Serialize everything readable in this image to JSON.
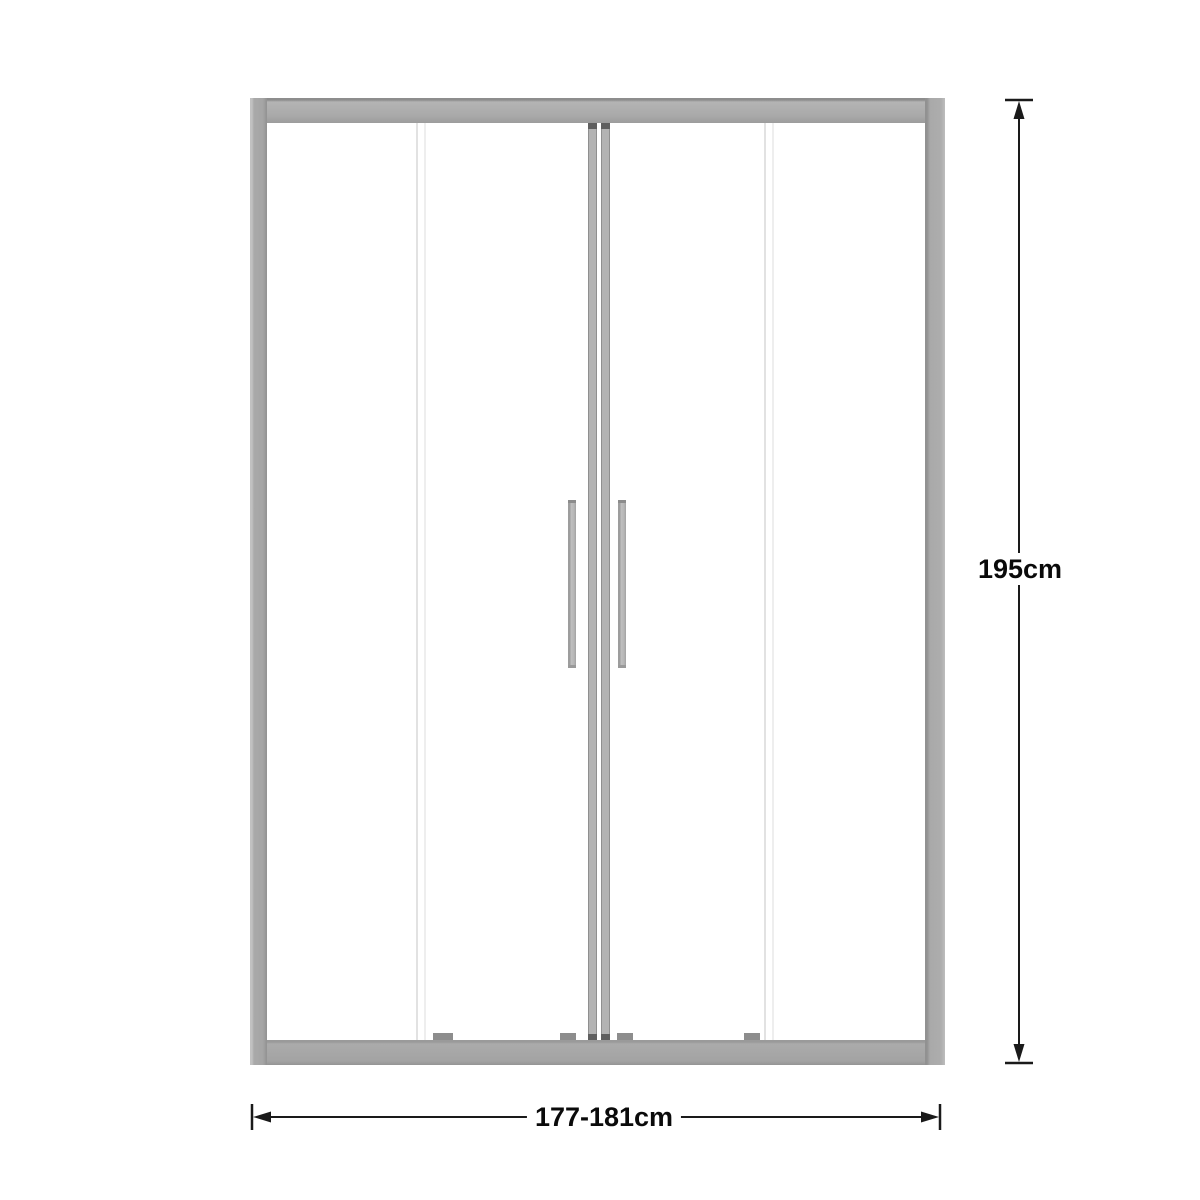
{
  "diagram": {
    "height_dimension": {
      "label": "195cm"
    },
    "width_dimension": {
      "label": "177-181cm"
    },
    "colors": {
      "frame_gray": "#a9a9a9",
      "frame_edge_gray": "#8e8e8e",
      "glass_edge_line": "#e5e5e5",
      "stile_cap_dark": "#5f5f5f",
      "dimension_line": "#1a1a1a",
      "label_text": "#0a0a0a",
      "background": "#ffffff"
    }
  }
}
